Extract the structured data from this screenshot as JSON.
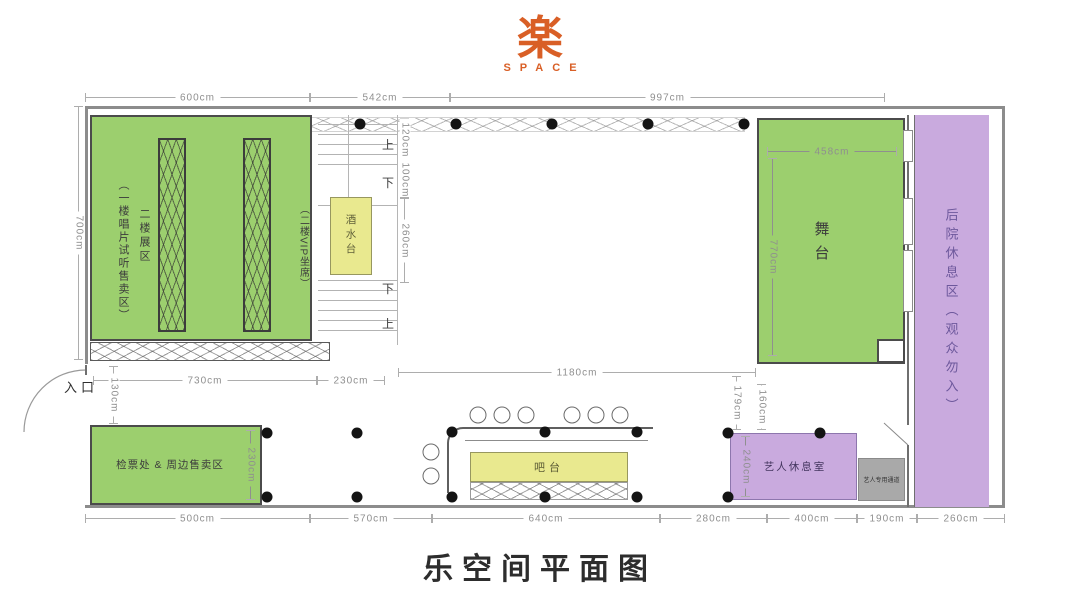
{
  "logo": {
    "glyph": "楽",
    "subtitle": "SPACE"
  },
  "title": "乐空间平面图",
  "colors": {
    "accent": "#d95f26",
    "green": "#9ccf6e",
    "yellow": "#e9e98f",
    "purple": "#c9aade",
    "gray_box": "#a9a9a9",
    "wall": "#8c8c8c",
    "dim_text": "#8f8f8f"
  },
  "rooms": {
    "record_area": "（一楼唱片试听售卖区）",
    "exhibit": "二楼展区",
    "vip": "（二楼VIP坐席）",
    "drink_station": "酒水台",
    "stage": "舞台",
    "backyard": "后院休息区（观众勿入）",
    "ticket": "检票处 & 周边售卖区",
    "bar": "吧台",
    "lounge": "艺人休息室",
    "passage": "艺人专用通道",
    "entrance": "入口"
  },
  "stairs": {
    "up": "上",
    "down": "下",
    "down2": "下",
    "up2": "上"
  },
  "dims": {
    "top_a": "600cm",
    "top_b": "542cm",
    "top_c": "997cm",
    "left": "700cm",
    "stage_w": "458cm",
    "stage_h": "770cm",
    "stair_a": "120cm",
    "stair_b": "100cm",
    "stair_c": "260cm",
    "mid_a": "730cm",
    "mid_b": "230cm",
    "mid_c": "1180cm",
    "entrance_h": "130cm",
    "ticket_h": "230cm",
    "lounge_a": "179cm",
    "lounge_b": "160cm",
    "lounge_h": "240cm",
    "bot_a": "500cm",
    "bot_b": "570cm",
    "bot_c": "640cm",
    "bot_d": "280cm",
    "bot_e": "400cm",
    "bot_f": "190cm",
    "bot_g": "260cm"
  }
}
